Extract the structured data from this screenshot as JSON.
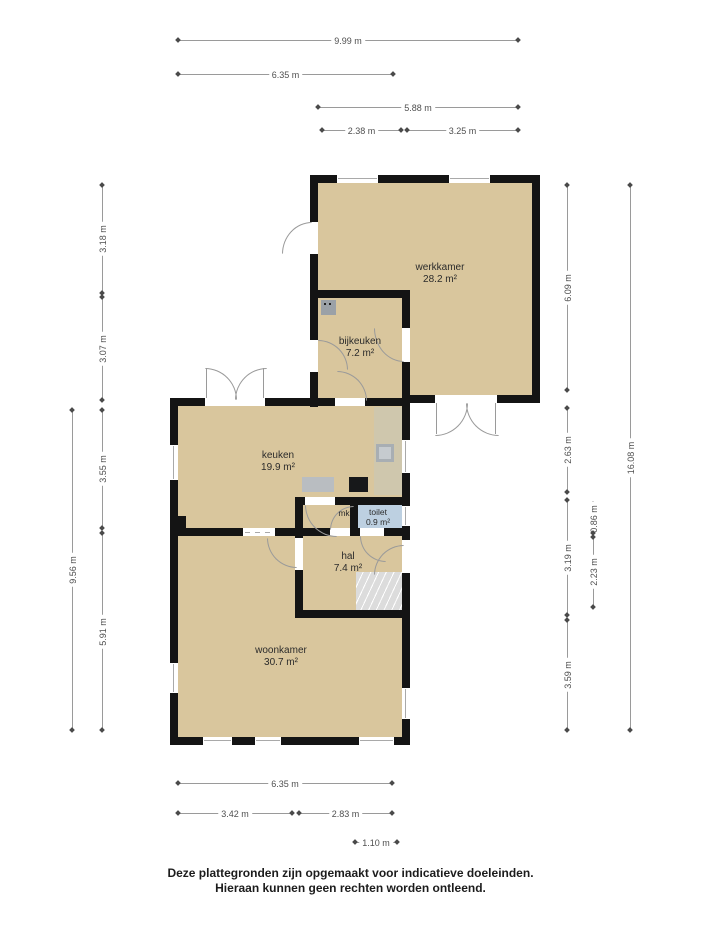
{
  "rooms": {
    "werkkamer": {
      "name": "werkkamer",
      "area": "28.2 m²"
    },
    "bijkeuken": {
      "name": "bijkeuken",
      "area": "7.2 m²"
    },
    "keuken": {
      "name": "keuken",
      "area": "19.9 m²"
    },
    "toilet": {
      "name": "toilet",
      "area": "0.9 m²"
    },
    "mk": {
      "name": "mk"
    },
    "hal": {
      "name": "hal",
      "area": "7.4 m²"
    },
    "woonkamer": {
      "name": "woonkamer",
      "area": "30.7 m²"
    }
  },
  "dims": {
    "top": [
      "9.99 m",
      "6.35 m",
      "5.88 m",
      "2.38 m",
      "3.25 m"
    ],
    "left": [
      "3.18 m",
      "3.07 m",
      "3.55 m",
      "9.56 m",
      "5.91 m"
    ],
    "right": [
      "6.09 m",
      "16.08 m",
      "2.63 m",
      "3.19 m",
      "3.59 m",
      "0.86 m",
      "2.23 m"
    ],
    "bottom": [
      "6.35 m",
      "3.42 m",
      "2.83 m",
      "1.10 m"
    ]
  },
  "footer": {
    "line1": "Deze plattegronden zijn opgemaakt voor indicatieve doeleinden.",
    "line2": "Hieraan kunnen geen rechten worden ontleend."
  },
  "colors": {
    "floor": "#d9c69d",
    "wall": "#141414",
    "toilet_floor": "#bdd0e1",
    "dimension_line": "#9a9a9a",
    "counter_gray": "#b9bdc1",
    "stairs": "#dcdcdc"
  }
}
